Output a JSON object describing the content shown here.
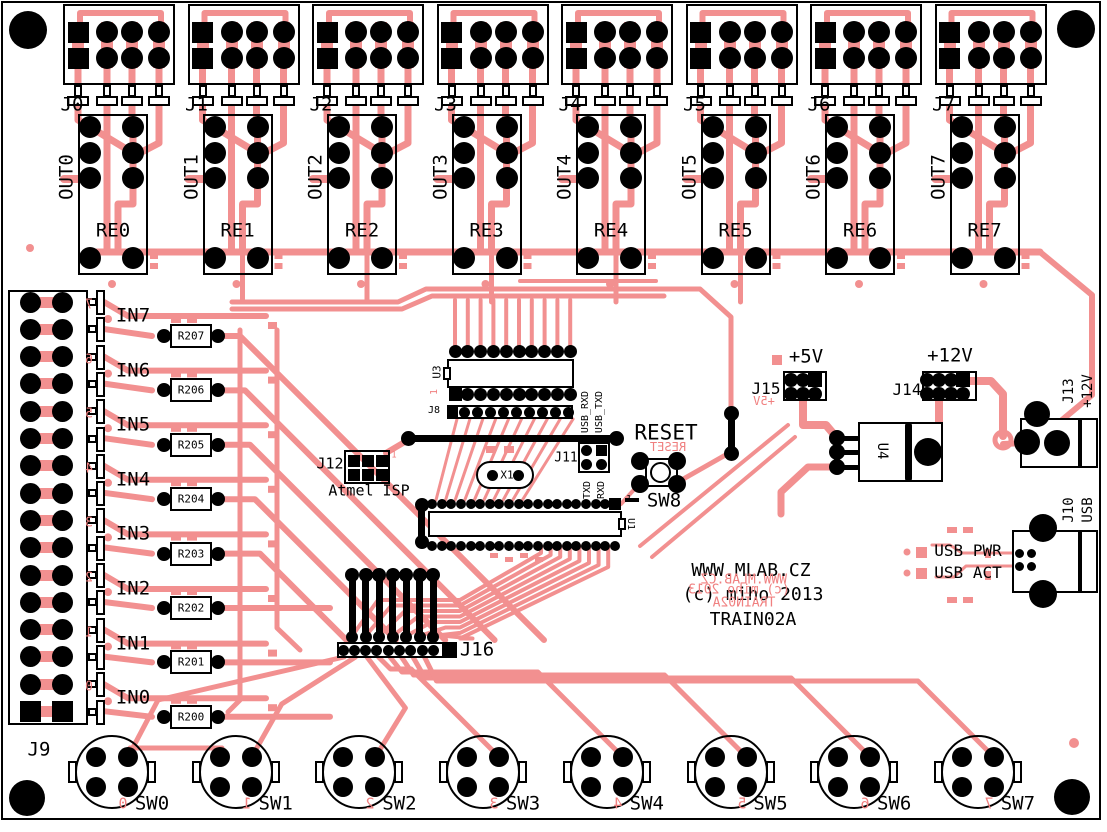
{
  "board": {
    "copper": "#F29090",
    "red_silk": "#F08080",
    "silk": "#000000",
    "title": "WWW.MLAB.CZ",
    "copyright": "(c) miho 2013",
    "name": "TRAIN02A",
    "title_mirror": "WWW.MLAB.CZ",
    "copyright_mirror": "(c) miho 2013",
    "name_mirror": "TRAIN02A"
  },
  "outputs": [
    {
      "connector": "J0",
      "relay": "RE0",
      "out": "OUT0"
    },
    {
      "connector": "J1",
      "relay": "RE1",
      "out": "OUT1"
    },
    {
      "connector": "J2",
      "relay": "RE2",
      "out": "OUT2"
    },
    {
      "connector": "J3",
      "relay": "RE3",
      "out": "OUT3"
    },
    {
      "connector": "J4",
      "relay": "RE4",
      "out": "OUT4"
    },
    {
      "connector": "J5",
      "relay": "RE5",
      "out": "OUT5"
    },
    {
      "connector": "J6",
      "relay": "RE6",
      "out": "OUT6"
    },
    {
      "connector": "J7",
      "relay": "RE7",
      "out": "OUT7"
    }
  ],
  "inputs": {
    "connector": "J9",
    "rows": [
      {
        "label": "IN7",
        "resistor": "R207",
        "pin_digit": "7"
      },
      {
        "label": "IN6",
        "resistor": "R206",
        "pin_digit": "6"
      },
      {
        "label": "IN5",
        "resistor": "R205",
        "pin_digit": "5"
      },
      {
        "label": "IN4",
        "resistor": "R204",
        "pin_digit": "4"
      },
      {
        "label": "IN3",
        "resistor": "R203",
        "pin_digit": "3"
      },
      {
        "label": "IN2",
        "resistor": "R202",
        "pin_digit": "2"
      },
      {
        "label": "IN1",
        "resistor": "R201",
        "pin_digit": "1"
      },
      {
        "label": "IN0",
        "resistor": "R200",
        "pin_digit": "0"
      }
    ]
  },
  "mcu": {
    "u3": "U3",
    "u3_pin1": "1",
    "j8": "J8",
    "usb_rxd": "USB_RXD",
    "usb_txd": "USB_TXD",
    "j11": "J11",
    "txd": "TXD",
    "rxd": "RXD",
    "j12": "J12",
    "j12_pin1": "1",
    "isp": "Atmel ISP",
    "x1": "X1",
    "reset": "RESET",
    "reset_mirror": "RESET",
    "sw8": "SW8",
    "u1": "U1",
    "u1_pin1": "1",
    "j16": "J16"
  },
  "power": {
    "j15": "J15",
    "v5": "+5V",
    "v5_mirror": "+5V",
    "j14": "J14",
    "v12": "+12V",
    "u4": "U4",
    "j13": "J13",
    "j13_v12": "+12V",
    "j10": "J10",
    "usb": "USB",
    "usb_pwr": "USB PWR",
    "usb_act": "USB ACT"
  },
  "switches": [
    {
      "label": "SW0",
      "digit": "0"
    },
    {
      "label": "SW1",
      "digit": "1"
    },
    {
      "label": "SW2",
      "digit": "2"
    },
    {
      "label": "SW3",
      "digit": "3"
    },
    {
      "label": "SW4",
      "digit": "4"
    },
    {
      "label": "SW5",
      "digit": "5"
    },
    {
      "label": "SW6",
      "digit": "6"
    },
    {
      "label": "SW7",
      "digit": "7"
    }
  ]
}
